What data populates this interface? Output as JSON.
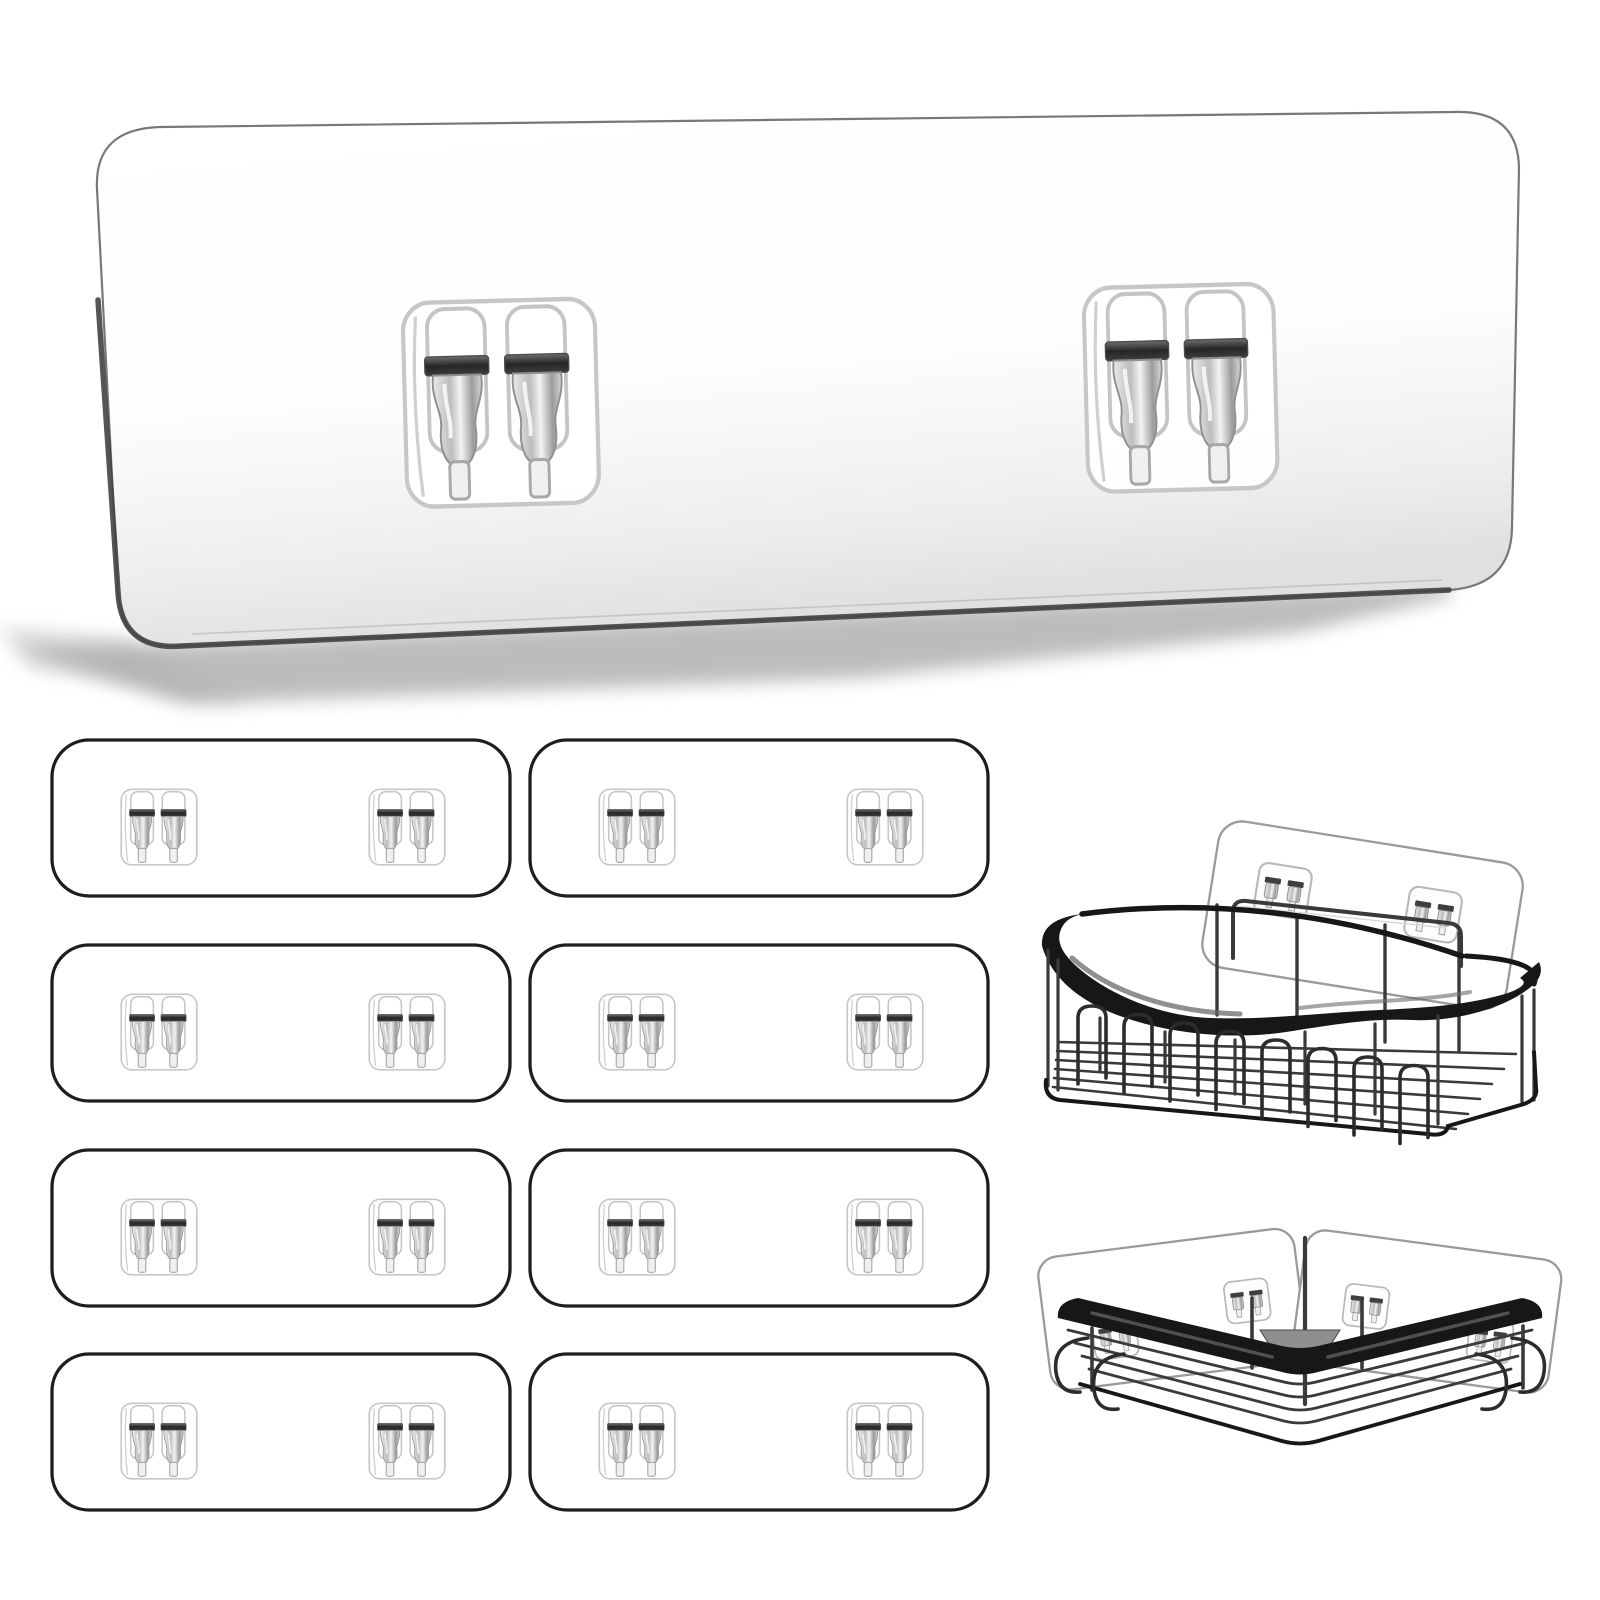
{
  "title": "Transparent adhesive replacement wall panels with twin hooks, shown with a black wire shower shelf caddy and a black corner shower caddy",
  "background": "#ffffff",
  "palette": {
    "bg": "#ffffff",
    "wire_black": "#171717",
    "wire_gray": "#3a3a3a",
    "hook_wire": "#2c2c2c",
    "sheen_gray": "#6a6a6a",
    "large_panel_border": "#787878",
    "large_panel_edge_dark": "#424242",
    "small_panel_border": "#1e1e1e",
    "pad_outline": "#c7c7c7",
    "hook_slot_outline": "#c4c4c4",
    "hook_tab_fill": "#f0f0f0",
    "mount_panel_border": "#9a9a9a",
    "mini_pad_outline": "#b8b8b8",
    "shadow_gray": "#8c8c8c"
  },
  "large_panel": {
    "pads": 2,
    "hooks_per_pad": 2
  },
  "small_panel_grid": {
    "count": 8,
    "columns": 2,
    "rows": 4,
    "pads_per_panel": 2,
    "hooks_per_pad": 2,
    "origins_x": [
      50,
      528
    ],
    "origins_y": [
      738,
      943,
      1148,
      1352
    ],
    "panel_width": 462,
    "panel_height": 160
  },
  "shelf_caddy": {
    "mount_pads": 2,
    "front_hooks": 8,
    "hook_start_x": 1092,
    "hook_start_y": 1006,
    "hook_dx": 46,
    "hook_dy": 8.5,
    "hook_width": 28,
    "hook_height": 78
  },
  "corner_caddy": {
    "mount_panels": 2,
    "mount_pads": 4,
    "end_hook_curls": 4
  }
}
